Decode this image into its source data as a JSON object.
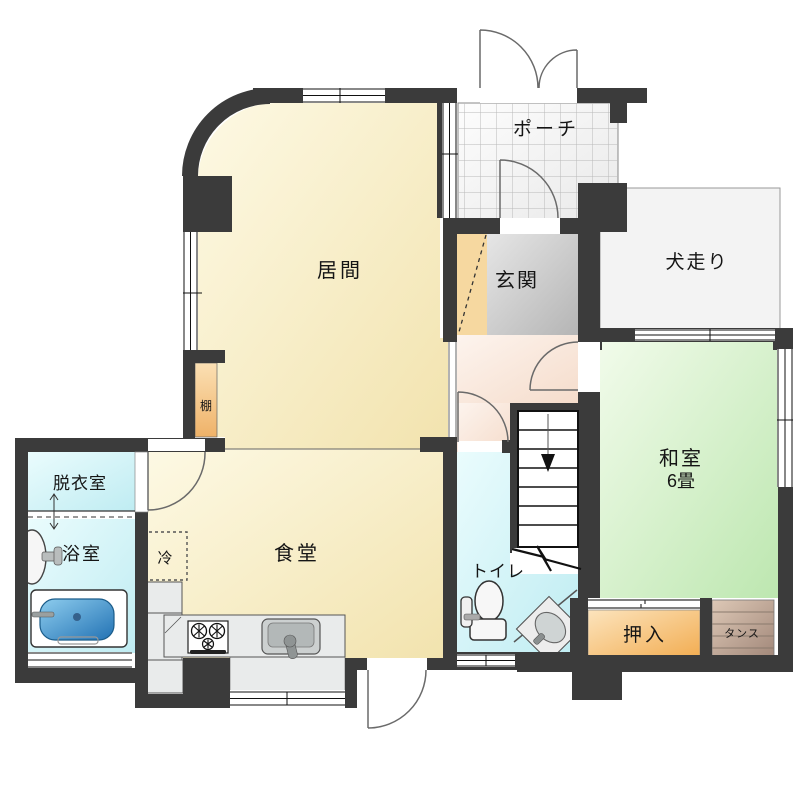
{
  "plan": {
    "rooms": {
      "porch": {
        "label": "ポーチ"
      },
      "entrance": {
        "label": "玄関"
      },
      "inubashiri": {
        "label": "犬走り"
      },
      "living": {
        "label": "居間"
      },
      "dining": {
        "label": "食堂"
      },
      "washitsu": {
        "label": "和室",
        "size": "6畳"
      },
      "dressing": {
        "label": "脱衣室"
      },
      "bath": {
        "label": "浴室"
      },
      "toilet": {
        "label": "トイレ"
      },
      "closet": {
        "label": "押入"
      },
      "tansu": {
        "label": "タンス"
      }
    },
    "fixtures": {
      "shelf": {
        "label": "棚"
      },
      "fridge": {
        "label": "冷"
      }
    },
    "colors": {
      "wall": "#3b3b3b",
      "living_light": "#fdf9e4",
      "living_dark": "#f2e3ae",
      "washitsu_light": "#f1fbea",
      "washitsu_dark": "#bde7b0",
      "wet_light": "#eafcfd",
      "wet_dark": "#bfecf2",
      "hall_light": "#fdf4ee",
      "hall_dark": "#f5dccb",
      "entrance_light": "#e6e6e6",
      "entrance_dark": "#b5b5b5",
      "step": "#f6d8a0",
      "closet_light": "#fce4bd",
      "closet_dark": "#f2ad52",
      "shelf_light": "#fbe0b4",
      "shelf_dark": "#efb268",
      "tansu_light": "#ddc8b6",
      "tansu_dark": "#a2887a",
      "porch_light": "#fdfdfd",
      "porch_dark": "#e9e9e9",
      "inubashiri_fill": "#f3f3f3",
      "counter": "#e9ebeb",
      "tub_light": "#8ecdee",
      "tub_dark": "#2272b4"
    }
  }
}
